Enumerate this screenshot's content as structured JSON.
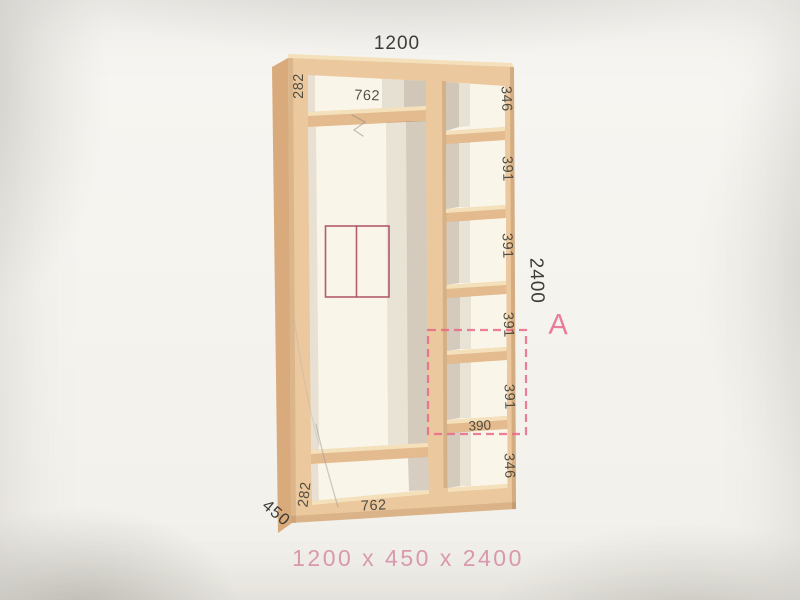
{
  "wardrobe_diagram": {
    "title_width_mm": "1200",
    "height_mm": "2400",
    "depth_mm": "450",
    "caption": "1200 x 450 x 2400",
    "zone_label": "A",
    "left_column": {
      "top_section_height": "282",
      "top_shelf_width": "762",
      "bottom_section_height": "282",
      "bottom_shelf_width": "762"
    },
    "right_column": {
      "section_heights": [
        "346",
        "391",
        "391",
        "391",
        "391",
        "346"
      ],
      "marked_shelf_width": "390"
    },
    "colors": {
      "wood": "#ebc89e",
      "wood_shadow": "#d9ab7c",
      "wood_highlight": "#f4e0ba",
      "accent_pink": "#e8688a",
      "symbol_rose": "#a84d62",
      "caption_pink": "#d795ac",
      "dimension_text": "#3e3c33"
    }
  }
}
